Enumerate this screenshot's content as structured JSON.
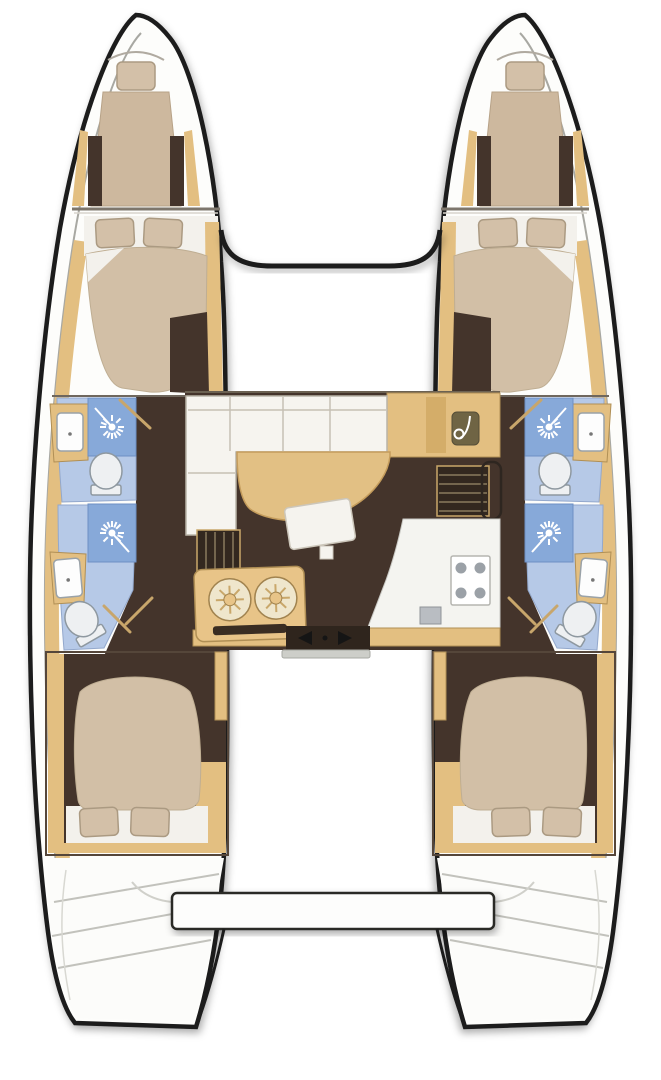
{
  "title": "Catamaran interior layout floor plan",
  "vessel": {
    "type": "sailing-catamaran",
    "view": "top-down-floor-plan",
    "hull_count": 2,
    "double_cabins": 4,
    "forepeak_berths": 2,
    "heads": 4
  },
  "palette": {
    "background": "#ffffff",
    "hull_outline": "#1c1c1c",
    "deck": "#fdfdfb",
    "wood": "#e3bf81",
    "wood_dark": "#b08f55",
    "floor_dark": "#44342b",
    "mattress": "#d2bfa6",
    "pillow": "#d3c0a8",
    "linen": "#f3f1ec",
    "bath_floor": "#b6c9e7",
    "shower_blue": "#87a9d9",
    "fixture_white": "#eef0f2",
    "fixture_stroke": "#8e98a0",
    "stove_burner": "#9ba1a7",
    "panel_olive": "#6f6444",
    "threshold_grey": "#cdcec9"
  },
  "rooms": {
    "port_hull": {
      "label": "Port hull",
      "spaces": [
        "forepeak berth",
        "forward double cabin",
        "forward head with shower",
        "aft head with shower",
        "aft double cabin",
        "transom steps"
      ]
    },
    "starboard_hull": {
      "label": "Starboard hull",
      "spaces": [
        "forepeak berth",
        "forward double cabin",
        "forward head with shower",
        "aft head with shower",
        "aft double cabin",
        "transom steps"
      ]
    },
    "saloon": {
      "label": "Saloon and galley",
      "features": [
        "L-shaped sofa",
        "curved dining table",
        "ottoman",
        "nav station with instrument panel",
        "companionway steps port",
        "companionway steps starboard",
        "galley unit with twin round sinks",
        "four-burner stove",
        "galley sink",
        "sliding door to cockpit"
      ]
    },
    "cockpit": {
      "label": "Aft cockpit",
      "features": [
        "cockpit bench"
      ]
    }
  },
  "icons": [
    {
      "name": "shower-head-icon",
      "meaning": "shower with sunburst spray"
    },
    {
      "name": "toilet-icon",
      "meaning": "marine toilet"
    },
    {
      "name": "sink-icon",
      "meaning": "washbasin"
    },
    {
      "name": "burner-icon",
      "meaning": "stove burner"
    },
    {
      "name": "instrument-panel-icon",
      "meaning": "nav station instrument"
    },
    {
      "name": "sliding-door-arrows-icon",
      "meaning": "sliding door opening direction"
    }
  ],
  "counts": {
    "stove_burners": 4,
    "galley_round_sinks": 2,
    "sofa_cushions": 4
  }
}
